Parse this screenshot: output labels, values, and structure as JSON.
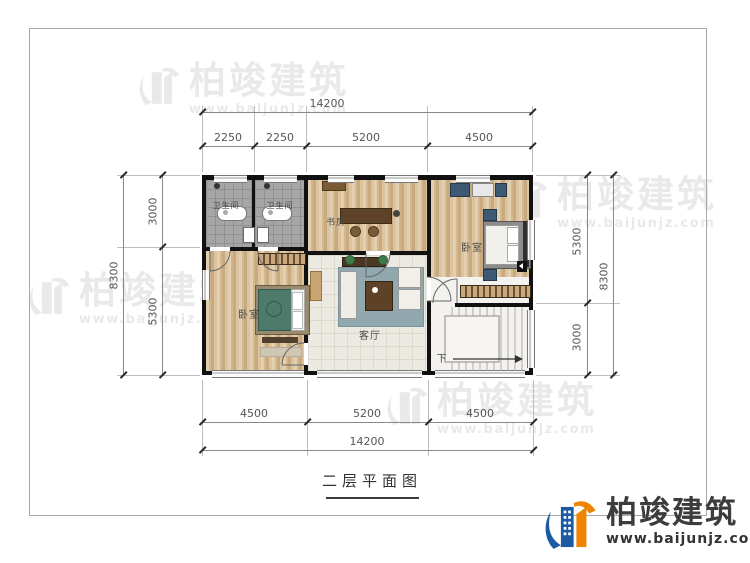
{
  "watermark": {
    "brand": "柏竣建筑",
    "url": "www.baijunjz.com"
  },
  "footer": {
    "brand": "柏竣建筑",
    "url": "www.baijunjz.com"
  },
  "plan": {
    "title": "二层平面图",
    "rooms": {
      "bathroom_1": "卫生间",
      "bathroom_2": "卫生间",
      "study": "书房",
      "bedroom_right": "卧室",
      "bedroom_left": "卧室",
      "living_room": "客厅",
      "stairs_down": "下"
    },
    "dimensions": {
      "top_total": "14200",
      "top_segments": [
        "2250",
        "2250",
        "5200",
        "4500"
      ],
      "left_outer": "8300",
      "left_segments": [
        "3000",
        "5300"
      ],
      "right_outer": "8300",
      "right_segments": [
        "5300",
        "3000"
      ],
      "bottom_total": "14200",
      "bottom_segments": [
        "4500",
        "5200",
        "4500"
      ]
    }
  },
  "colors": {
    "brand_blue": "#1d5aa4",
    "brand_orange": "#f08300",
    "wall": "#111111",
    "wood_floor": "#d8bd96",
    "bath_floor": "#a6a6a6"
  }
}
